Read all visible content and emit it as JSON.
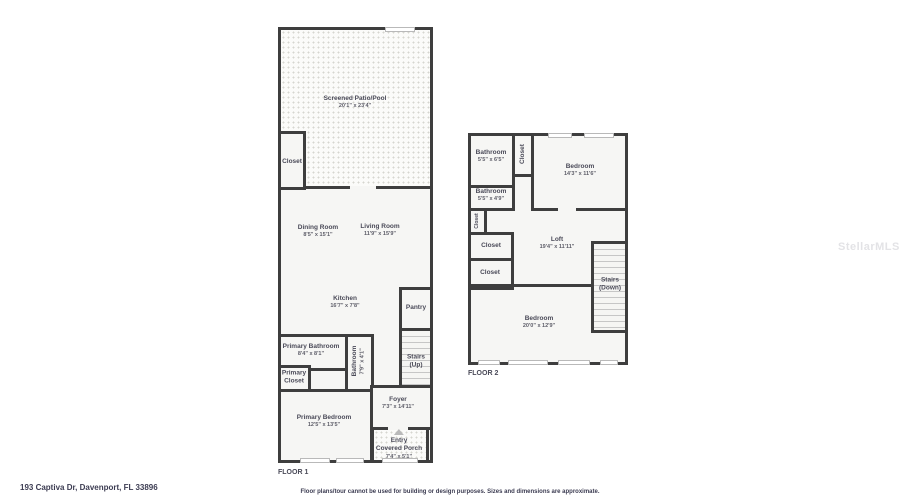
{
  "watermark": "StellarMLS",
  "footer": {
    "address": "193 Captiva Dr, Davenport, FL 33896",
    "disclaimer": "Floor plans/tour cannot be used for building or design purposes. Sizes and dimensions are approximate."
  },
  "floor1": {
    "tag": "FLOOR 1",
    "patio": {
      "name": "Screened Patio/Pool",
      "dims": "20'1\" x 23'4\""
    },
    "closet": {
      "name": "Closet"
    },
    "dining": {
      "name": "Dining Room",
      "dims": "8'5\" x 15'1\""
    },
    "living": {
      "name": "Living Room",
      "dims": "11'9\" x 15'9\""
    },
    "kitchen": {
      "name": "Kitchen",
      "dims": "16'7\" x 7'8\""
    },
    "pantry": {
      "name": "Pantry"
    },
    "stairs": {
      "name": "Stairs",
      "dir": "(Up)"
    },
    "primary_bathroom": {
      "name": "Primary Bathroom",
      "dims": "8'4\" x 8'1\""
    },
    "bathroom": {
      "name": "Bathroom",
      "dims": "7'9\" x 4'1\""
    },
    "primary_closet": {
      "line1": "Primary",
      "line2": "Closet"
    },
    "primary_bedroom": {
      "name": "Primary Bedroom",
      "dims": "12'5\" x 13'5\""
    },
    "foyer": {
      "name": "Foyer",
      "dims": "7'3\" x 14'11\""
    },
    "porch": {
      "line1": "Entry",
      "line2": "Covered Porch",
      "dims": "7'4\" x 5'1\""
    }
  },
  "floor2": {
    "tag": "FLOOR 2",
    "bathroom_top": {
      "name": "Bathroom",
      "dims": "5'5\" x 6'5\""
    },
    "closet_top": {
      "name": "Closet"
    },
    "bedroom_right": {
      "name": "Bedroom",
      "dims": "14'3\" x 11'6\""
    },
    "bathroom_mid": {
      "name": "Bathroom",
      "dims": "5'5\" x 4'9\""
    },
    "closet_small": {
      "name": "Closet"
    },
    "closet_mid": {
      "name": "Closet"
    },
    "closet_low": {
      "name": "Closet"
    },
    "loft": {
      "name": "Loft",
      "dims": "19'4\" x 11'11\""
    },
    "stairs": {
      "name": "Stairs",
      "dir": "(Down)"
    },
    "bedroom_main": {
      "name": "Bedroom",
      "dims": "20'0\" x 12'9\""
    }
  }
}
